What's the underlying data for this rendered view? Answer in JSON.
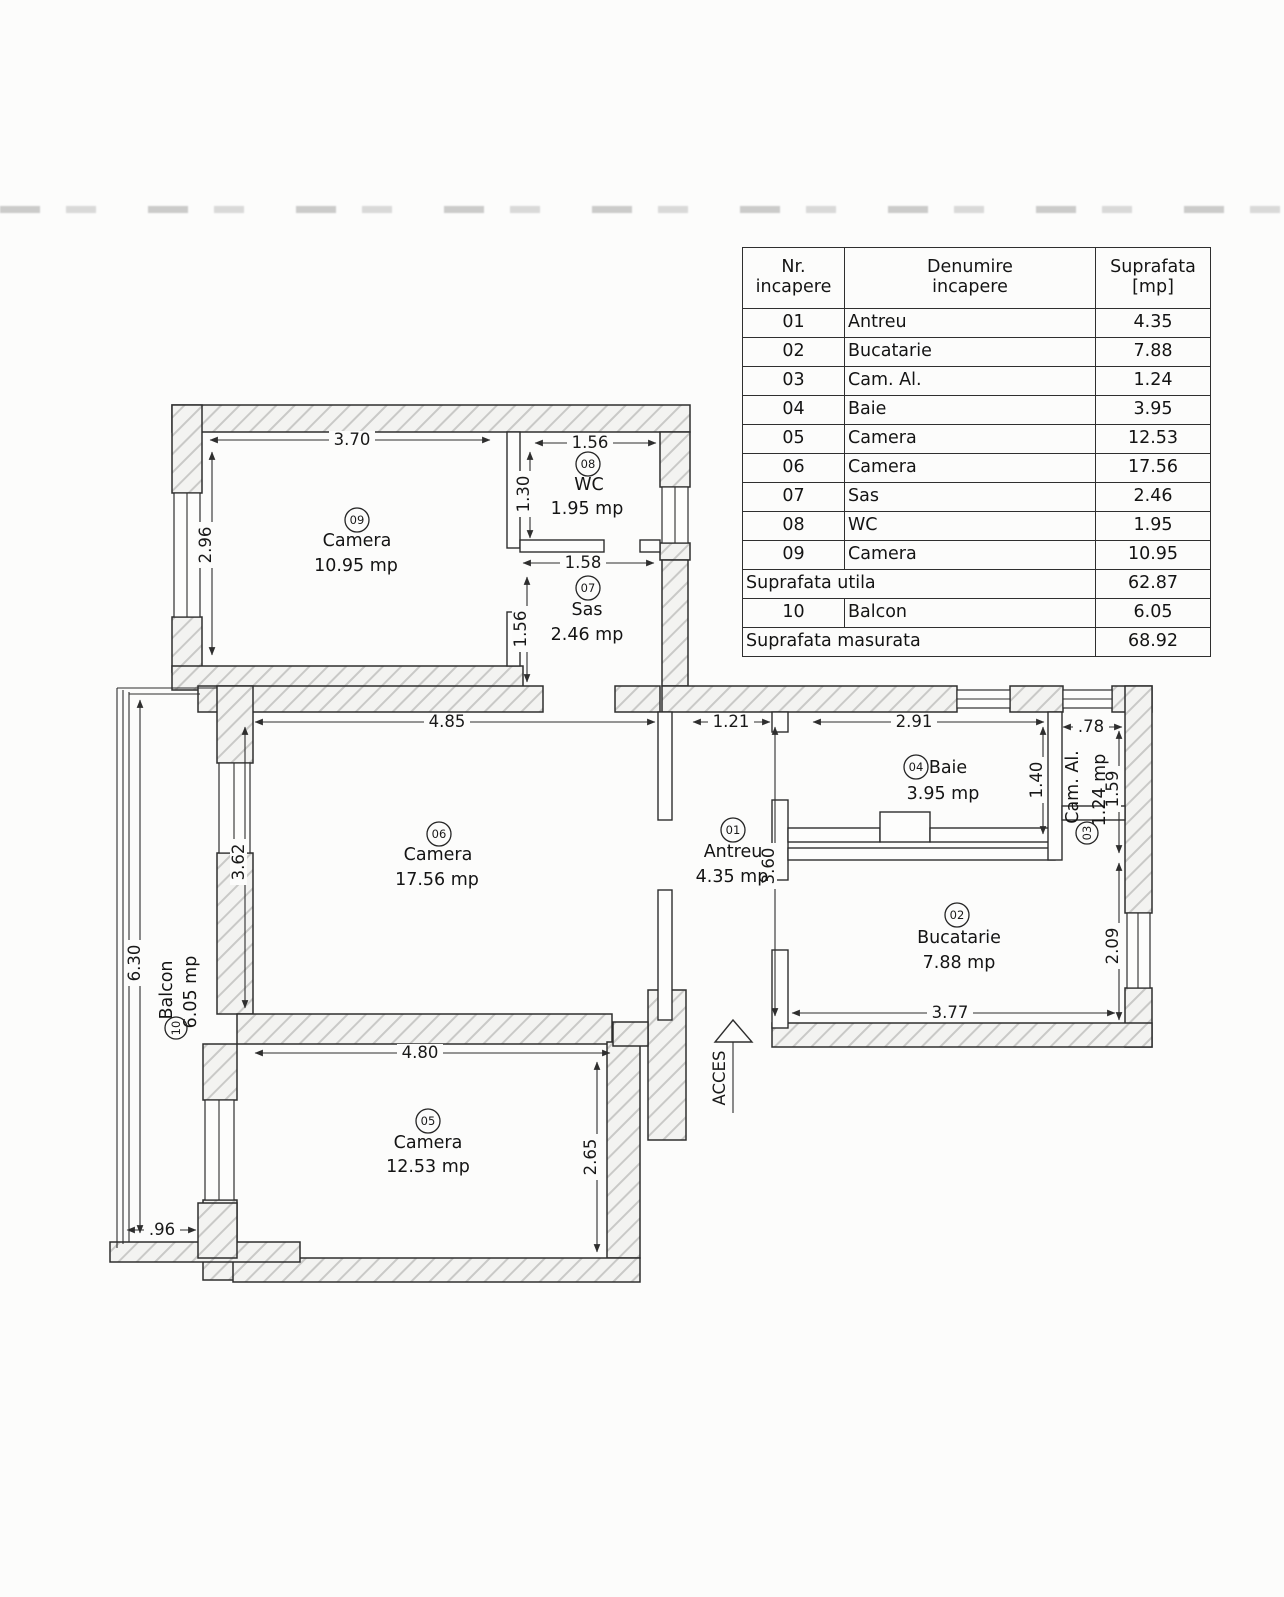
{
  "table": {
    "header": {
      "col1_line1": "Nr.",
      "col1_line2": "incapere",
      "col2_line1": "Denumire",
      "col2_line2": "incapere",
      "col3_line1": "Suprafata",
      "col3_line2": "[mp]"
    },
    "rows": [
      {
        "nr": "01",
        "name": "Antreu",
        "area": "4.35"
      },
      {
        "nr": "02",
        "name": "Bucatarie",
        "area": "7.88"
      },
      {
        "nr": "03",
        "name": "Cam. Al.",
        "area": "1.24"
      },
      {
        "nr": "04",
        "name": "Baie",
        "area": "3.95"
      },
      {
        "nr": "05",
        "name": "Camera",
        "area": "12.53"
      },
      {
        "nr": "06",
        "name": "Camera",
        "area": "17.56"
      },
      {
        "nr": "07",
        "name": "Sas",
        "area": "2.46"
      },
      {
        "nr": "08",
        "name": "WC",
        "area": "1.95"
      },
      {
        "nr": "09",
        "name": "Camera",
        "area": "10.95"
      }
    ],
    "suprafata_utila": {
      "label": "Suprafata utila",
      "value": "62.87"
    },
    "balcon_row": {
      "nr": "10",
      "name": "Balcon",
      "area": "6.05"
    },
    "suprafata_masurata": {
      "label": "Suprafata masurata",
      "value": "68.92"
    }
  },
  "plan": {
    "acces_label": "ACCES",
    "rooms": {
      "r01": {
        "num": "01",
        "name": "Antreu",
        "area": "4.35 mp"
      },
      "r02": {
        "num": "02",
        "name": "Bucatarie",
        "area": "7.88 mp"
      },
      "r03": {
        "num": "03",
        "name": "Cam. Al.",
        "area": "1.24 mp"
      },
      "r04": {
        "num": "04",
        "name": "Baie",
        "area": "3.95 mp"
      },
      "r05": {
        "num": "05",
        "name": "Camera",
        "area": "12.53 mp"
      },
      "r06": {
        "num": "06",
        "name": "Camera",
        "area": "17.56 mp"
      },
      "r07": {
        "num": "07",
        "name": "Sas",
        "area": "2.46 mp"
      },
      "r08": {
        "num": "08",
        "name": "WC",
        "area": "1.95 mp"
      },
      "r09": {
        "num": "09",
        "name": "Camera",
        "area": "10.95 mp"
      },
      "r10": {
        "num": "10",
        "name": "Balcon",
        "area": "6.05 mp"
      }
    },
    "dims": {
      "room09_width": "3.70",
      "room09_height": "2.96",
      "wc_width": "1.56",
      "wc_height": "1.30",
      "sas_width": "1.58",
      "sas_height": "1.56",
      "room06_width": "4.85",
      "room06_height": "3.62",
      "antreu_width": "1.21",
      "antreu_height": "3.60",
      "baie_width": "2.91",
      "baie_height": "1.40",
      "camal_width": ".78",
      "camal_height": "1.59",
      "bucatarie_width": "3.77",
      "bucatarie_height": "2.09",
      "balcon_height": "6.30",
      "balcon_width": ".96",
      "room05_width": "4.80",
      "room05_height": "2.65"
    }
  }
}
